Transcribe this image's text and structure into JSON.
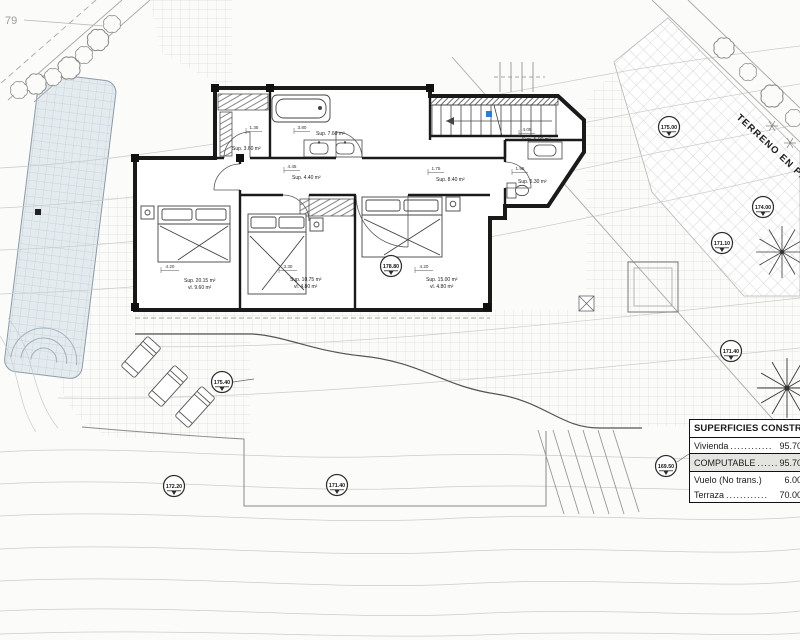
{
  "meta": {
    "parcel_number": "79",
    "terrain_label": "TERRENO EN PENDIENTE",
    "colors": {
      "wall": "#1a1a1a",
      "accent_blue": "#2f7bd8",
      "pool_fill": "#e4ebef",
      "grid_line": "#dcdcdc",
      "contour_line": "#cccccc",
      "highlight_row": "#e4e4e1",
      "paper": "#fbfbf9"
    }
  },
  "table": {
    "title": "SUPERFICIES CONSTRUIDA",
    "rows": [
      {
        "label": "Vivienda",
        "dots": "............",
        "value": "95.70"
      },
      {
        "label": "COMPUTABLE",
        "dots": ".......",
        "value": "95.70"
      },
      {
        "label": "Vuelo (No trans.)",
        "dots": "",
        "value": "6.00"
      },
      {
        "label": "Terraza",
        "dots": "............",
        "value": "70.00"
      }
    ]
  },
  "rooms": {
    "dressing": {
      "sup": "Sup. 3.60 m²",
      "dim_a": "1.35",
      "dim_b": "3.80"
    },
    "bath_main": {
      "sup": "Sup. 7.60 m²"
    },
    "hall": {
      "sup": "Sup. 4.40 m²",
      "dim": "4.45"
    },
    "corridor": {
      "sup": "Sup. 8.40 m²",
      "dim": "1.75"
    },
    "stairs": {
      "sup": "Sup. 5.00 m²",
      "dim": "4.05"
    },
    "bath_guest": {
      "sup": "Sup. 5.30 m²",
      "dim": "1.95"
    },
    "bedroom_1": {
      "sup": "Sup. 20.15 m²",
      "vl": "vl. 9.60 m²",
      "dim": "4.20"
    },
    "bedroom_2": {
      "sup": "Sup. 10.75 m²",
      "vl": "vl. 4.80 m²",
      "dim": "3.30"
    },
    "bedroom_3": {
      "sup": "Sup. 15.00 m²",
      "vl": "vl. 4.80 m²",
      "dim": "4.20"
    }
  },
  "levels": [
    {
      "value": "175.00"
    },
    {
      "value": "174.00"
    },
    {
      "value": "171.10"
    },
    {
      "value": "171.40"
    },
    {
      "value": "175.40"
    },
    {
      "value": "172.20"
    },
    {
      "value": "171.40"
    },
    {
      "value": "169.50"
    },
    {
      "value": "178.80"
    }
  ]
}
